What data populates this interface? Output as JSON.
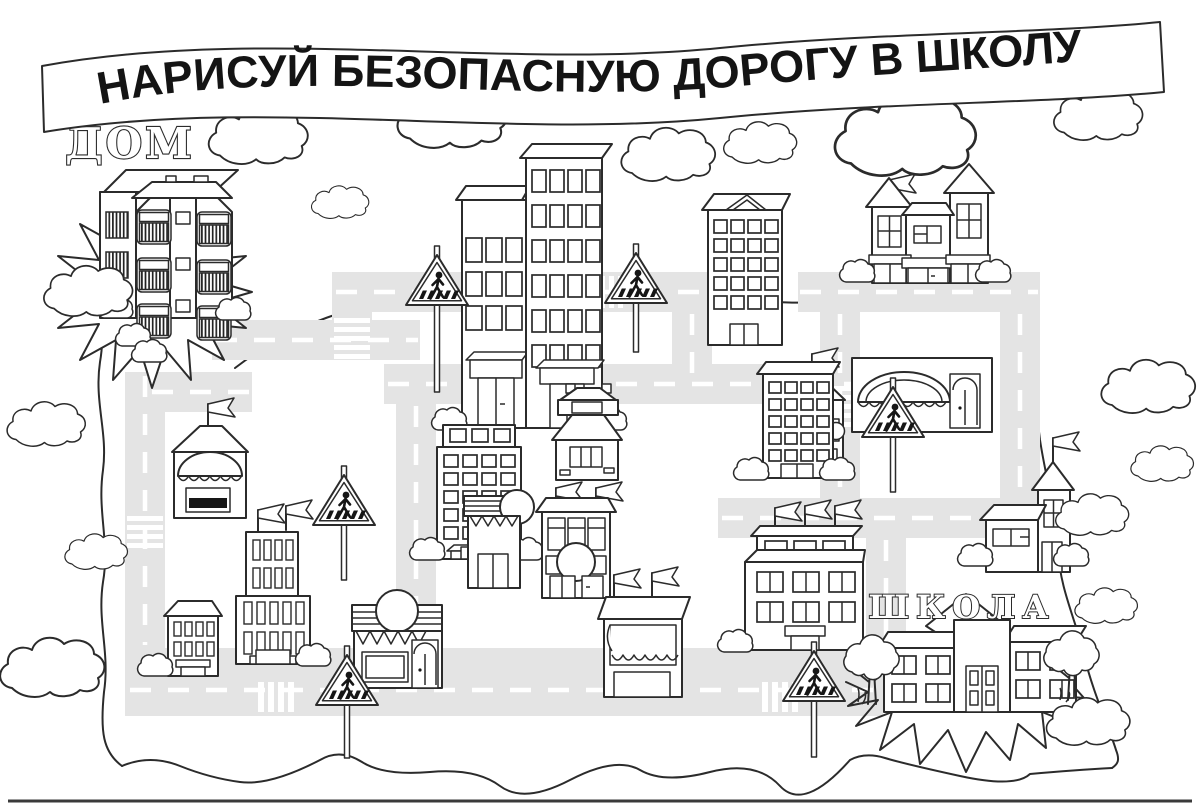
{
  "page": {
    "title": "НАРИСУЙ БЕЗОПАСНУЮ ДОРОГУ В ШКОЛУ"
  },
  "labels": {
    "home": "ДОМ",
    "school": "ШКОЛА"
  },
  "colors": {
    "ink": "#2b2b2b",
    "road": "#e4e4e4",
    "paper": "#ffffff",
    "sign_figure": "#161616"
  },
  "scene": {
    "crossing_signs": 6,
    "crosswalks": 6,
    "clouds": 16,
    "buildings": [
      "home-apartment-block",
      "office-tower-small",
      "office-tower-tall",
      "gable-roof-tower",
      "kindergarten-castle",
      "cottage",
      "fruit-kiosk",
      "mid-office-tower",
      "tram-kiosk",
      "right-office-tower",
      "bakery-dome-awning",
      "tower-house",
      "admin-building-flags",
      "cafe-awning",
      "shop-round-sign",
      "clock-shop",
      "stepped-skyscraper",
      "small-house",
      "ice-cream-kiosk",
      "school-building"
    ]
  }
}
